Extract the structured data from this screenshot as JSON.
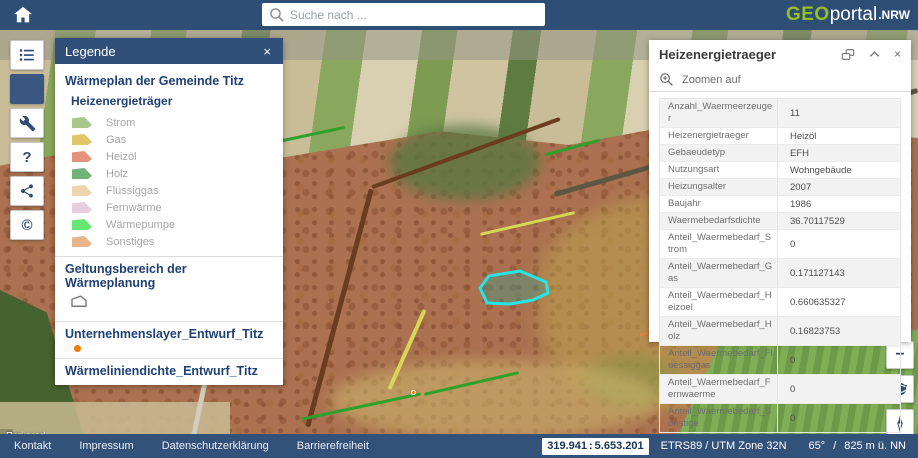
{
  "topbar": {
    "search_placeholder": "Suche nach ...",
    "logo": {
      "geo": "GEO",
      "portal": "portal",
      "nrw": ".NRW"
    }
  },
  "tools": {
    "help_label": "?",
    "copyright_label": "©"
  },
  "legend": {
    "title": "Legende",
    "close_label": "×",
    "group1_title": "Wärmeplan der Gemeinde Titz",
    "subgroup_title": "Heizenergieträger",
    "energy_items": [
      {
        "label": "Strom",
        "color": "#a9c78b"
      },
      {
        "label": "Gas",
        "color": "#e3c468"
      },
      {
        "label": "Heizöl",
        "color": "#e2937a"
      },
      {
        "label": "Holz",
        "color": "#72b378"
      },
      {
        "label": "Flüssiggas",
        "color": "#ecd5ae"
      },
      {
        "label": "Fernwärme",
        "color": "#e6cfdb"
      },
      {
        "label": "Wärmepumpe",
        "color": "#66e673"
      },
      {
        "label": "Sonstiges",
        "color": "#e7b48b"
      }
    ],
    "group2_title": "Geltungsbereich der Wärmeplanung",
    "group3_title": "Unternehmenslayer_Entwurf_Titz",
    "point_color": "#f07d00",
    "group4_title": "Wärmeliniendichte_Entwurf_Titz",
    "density_title": "Wärmeliniendichte",
    "line_items": [
      {
        "label": "ab 2000 kwh/m a",
        "color": "#7a3a12"
      },
      {
        "label": "1750 - 2000 kwh/m a",
        "color": "#bc6524"
      }
    ]
  },
  "feature_panel": {
    "title": "Heizenergietraeger",
    "collapse_label": "⌃",
    "close_label": "×",
    "zoom_to_label": "Zoomen auf",
    "rows": [
      {
        "label": "Anzahl_Waermeerzeuger",
        "value": "11"
      },
      {
        "label": "Heizenergietraeger",
        "value": "Heizöl"
      },
      {
        "label": "Gebaeudetyp",
        "value": "EFH"
      },
      {
        "label": "Nutzungsart",
        "value": "Wohngebäude"
      },
      {
        "label": "Heizungsalter",
        "value": "2007"
      },
      {
        "label": "Baujahr",
        "value": "1986"
      },
      {
        "label": "Waermebedarfsdichte",
        "value": "36.70117529"
      },
      {
        "label": "Anteil_Waermebedarf_Strom",
        "value": "0"
      },
      {
        "label": "Anteil_Waermebedarf_Gas",
        "value": "0.171127143"
      },
      {
        "label": "Anteil_Waermebedarf_Heizoel",
        "value": "0.660635327"
      },
      {
        "label": "Anteil_Waermebedarf_Holz",
        "value": "0.16823753"
      },
      {
        "label": "Anteil_Waermebedarf_Fluessiggas",
        "value": "0"
      },
      {
        "label": "Anteil_Waermebedarf_Fernwaerme",
        "value": "0"
      },
      {
        "label": "Anteil_Waermebedarf_Sonstige",
        "value": "0"
      }
    ]
  },
  "map_controls": {
    "zoom_out_label": "−"
  },
  "map": {
    "attribution_prefix": "Powered by ",
    "attribution_link": "Esri",
    "selection_color": "#29e4e4"
  },
  "footer": {
    "links": [
      {
        "label": "Kontakt"
      },
      {
        "label": "Impressum"
      },
      {
        "label": "Datenschutzerklärung"
      },
      {
        "label": "Barrierefreiheit"
      }
    ],
    "coord_x": "319.941",
    "coord_sep": ":",
    "coord_y": "5.653.201",
    "crs": "ETRS89 / UTM Zone 32N",
    "tilt": "65°",
    "separator": "/",
    "elevation": "825 m ü. NN"
  },
  "colors": {
    "bar_navy": "#2f4e76",
    "logo_green": "#96c11e",
    "icon_navy": "#2d4a73"
  }
}
